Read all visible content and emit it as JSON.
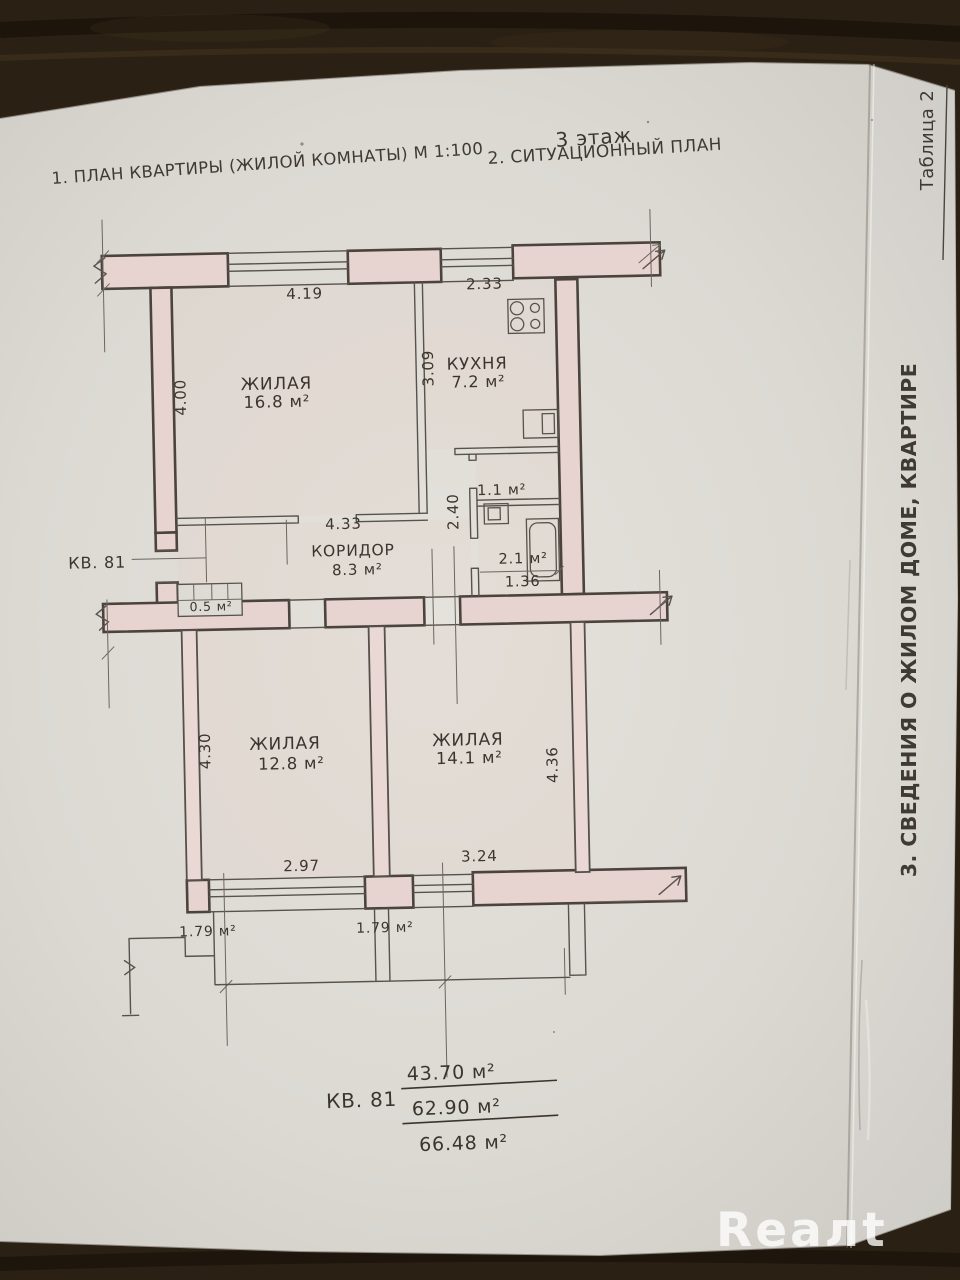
{
  "photo": {
    "background_color": "#2a2013",
    "paper_color": "#dedbd5",
    "ink_color": "#3a352e",
    "wall_fill_color": "#e7d3d0"
  },
  "header": {
    "title_plan": "1. ПЛАН КВАРТИРЫ (ЖИЛОЙ КОМНАТЫ) М 1:100",
    "title_situational": "2. СИТУАЦИОННЫЙ ПЛАН",
    "floor_note": "3 этаж"
  },
  "sidebar": {
    "table_label": "Таблица 2",
    "section_title": "3. СВЕДЕНИЯ О ЖИЛОМ ДОМЕ, КВАРТИРЕ"
  },
  "plan": {
    "apartment_label": "КВ. 81",
    "rooms": [
      {
        "id": "living-1",
        "name": "ЖИЛАЯ",
        "area": "16.8 м²"
      },
      {
        "id": "kitchen",
        "name": "КУХНЯ",
        "area": "7.2 м²"
      },
      {
        "id": "corridor",
        "name": "КОРИДОР",
        "area": "8.3 м²"
      },
      {
        "id": "wc",
        "name": "",
        "area": "1.1 м²"
      },
      {
        "id": "bathroom",
        "name": "",
        "area": "2.1 м²"
      },
      {
        "id": "closet",
        "name": "",
        "area": "0.5 м²"
      },
      {
        "id": "living-2",
        "name": "ЖИЛАЯ",
        "area": "12.8 м²"
      },
      {
        "id": "living-3",
        "name": "ЖИЛАЯ",
        "area": "14.1 м²"
      },
      {
        "id": "balcony-1",
        "name": "",
        "area": "1.79 м²"
      },
      {
        "id": "balcony-2",
        "name": "",
        "area": "1.79 м²"
      }
    ],
    "dims": {
      "top_window_left": "4.19",
      "top_window_right": "2.33",
      "living1_depth": "4.00",
      "kitchen_depth": "3.09",
      "corridor_width": "4.33",
      "bath_depth": "2.40",
      "bath_width": "1.36",
      "living2_width": "2.97",
      "living3_width": "3.24",
      "living2_depth": "4.30",
      "living3_depth": "4.36"
    }
  },
  "totals": {
    "apartment_label": "КВ. 81",
    "living_area": "43.70 м²",
    "total_area": "62.90 м²",
    "total_with_balconies": "66.48 м²"
  },
  "watermark": {
    "text": "Reaлt"
  }
}
